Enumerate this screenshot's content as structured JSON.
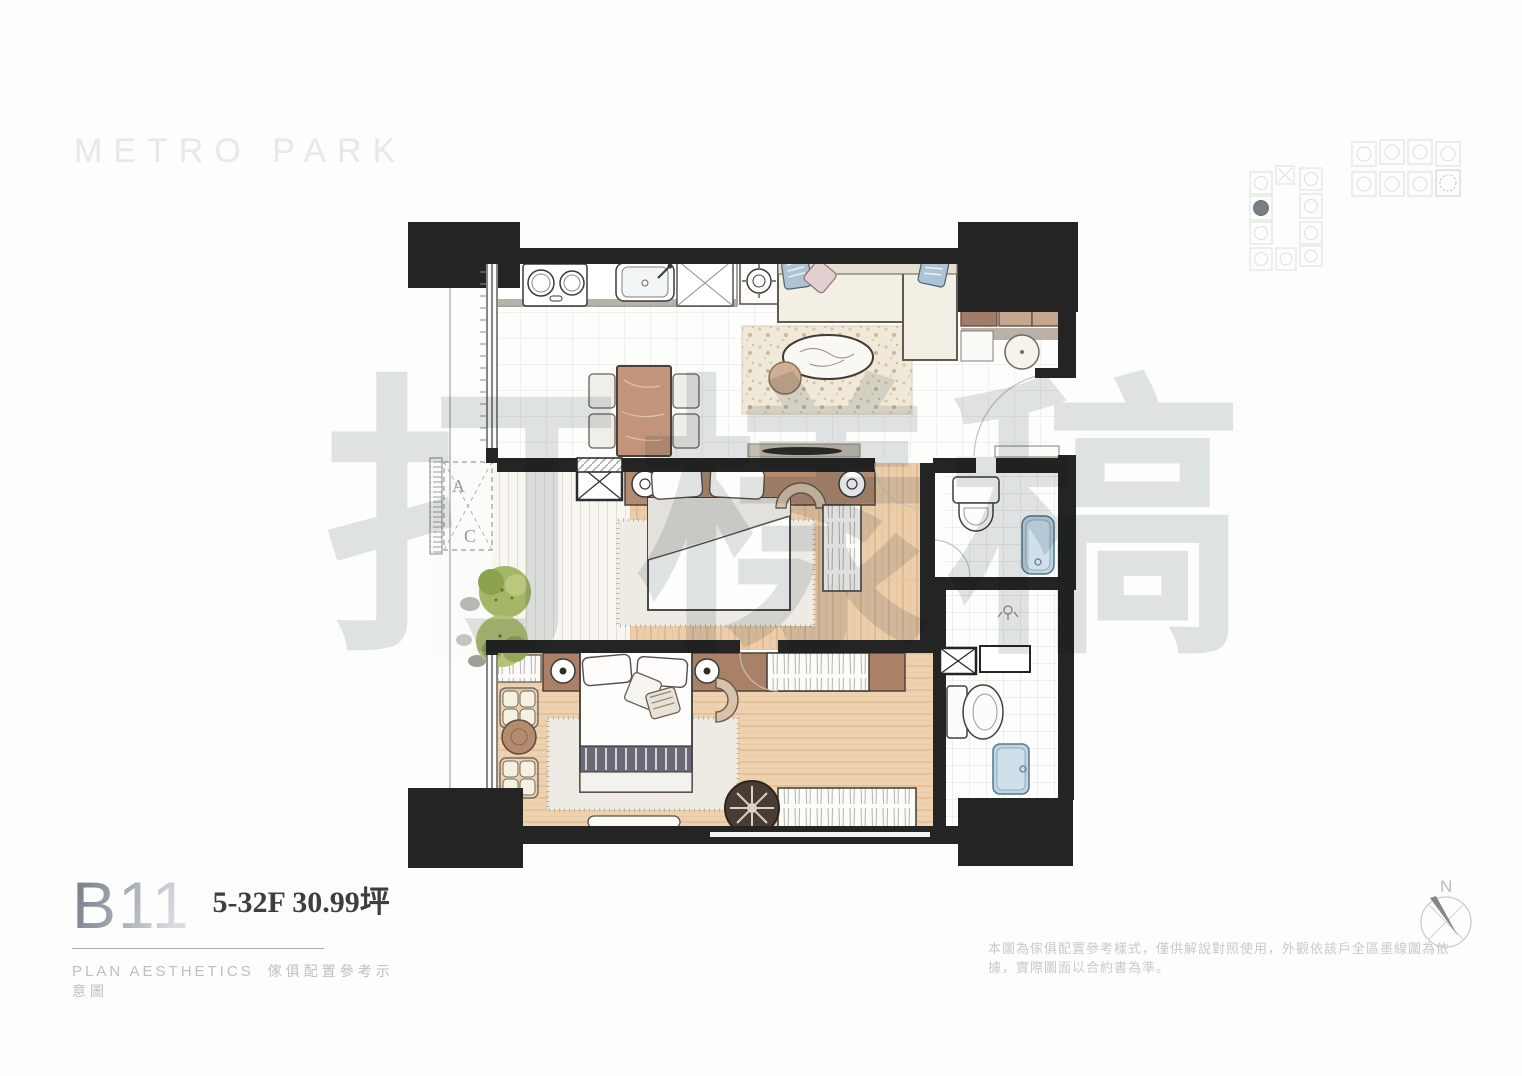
{
  "brand": {
    "logo_text": "METRO PARK"
  },
  "unit": {
    "code": "B11",
    "spec": "5-32F 30.99坪"
  },
  "caption": {
    "en": "PLAN AESTHETICS",
    "zh": "傢俱配置參考示意圖"
  },
  "plan": {
    "ac_label_top": "A",
    "ac_label_bottom": "C"
  },
  "compass": {
    "north_label": "N"
  },
  "watermark": {
    "text": "打樣稿"
  },
  "disclaimer": {
    "text": "本圖為傢俱配置參考樣式，僅供解說對照使用，外觀依該戶全區墨線圖為依據，實際圖面以合約書為準。"
  },
  "colors": {
    "wall_black": "#242424",
    "wood_floor_warm": "#eccdaa",
    "headboard_brown": "#b28b70",
    "cabinet_brown": "#c7a68f",
    "fixture_blue": "#bed4e2",
    "plant_green": "#a3b766",
    "rug_speckle": "#f0e9da",
    "watermark_gray": "#c9cdd2",
    "logo_gray": "#e6e8ea",
    "spec_text": "#3e3e41",
    "disclaimer_gray": "#c7c9cb"
  }
}
